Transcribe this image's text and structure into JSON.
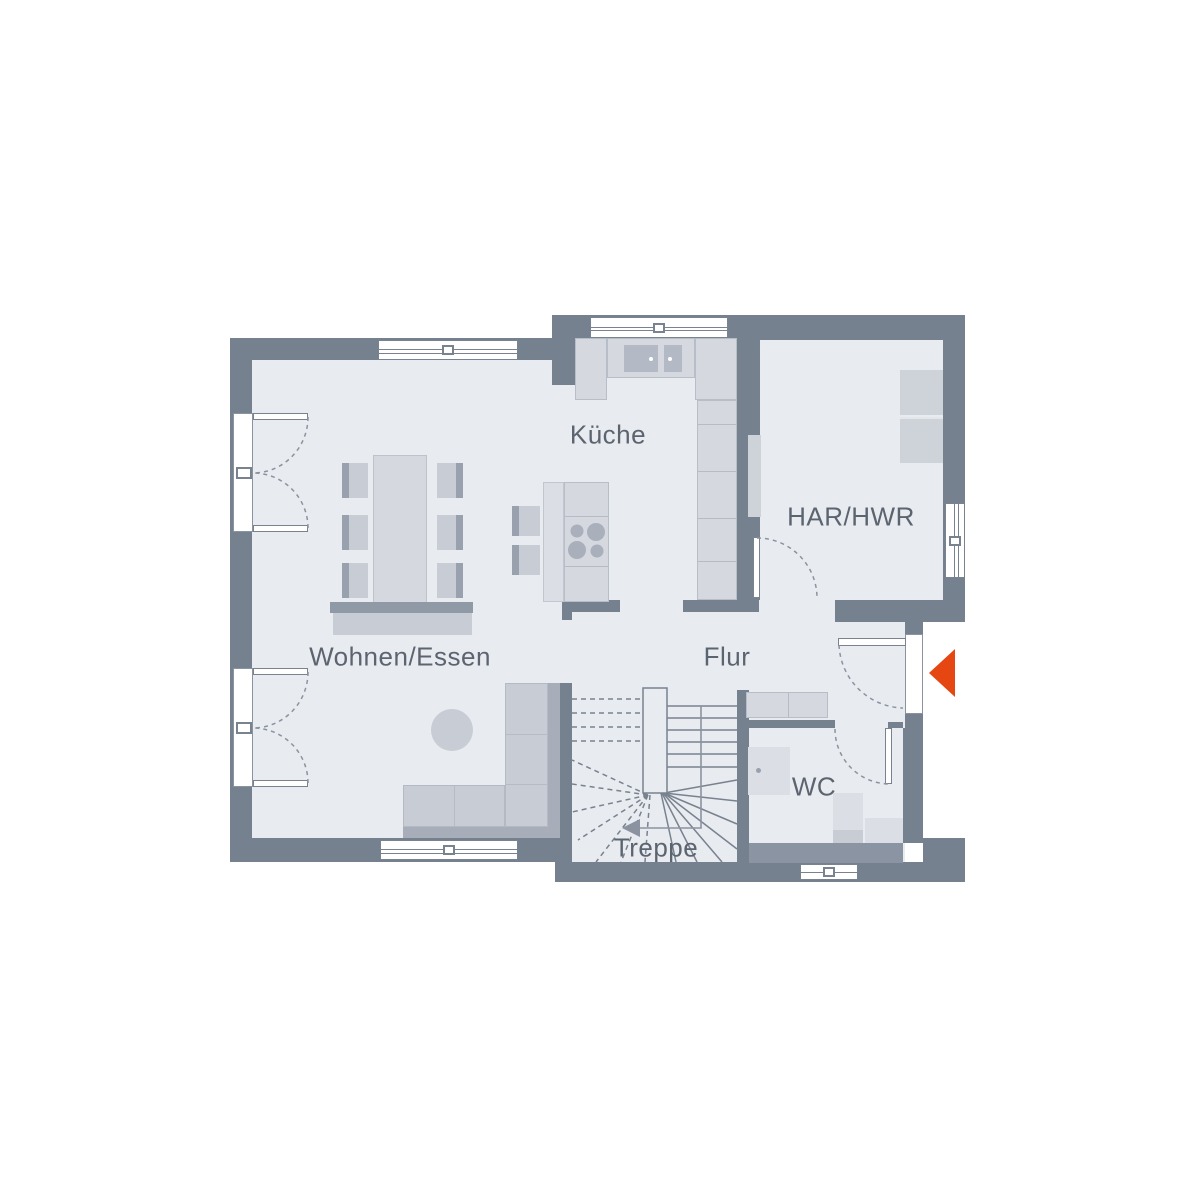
{
  "plan": {
    "type": "floor-plan",
    "rooms": [
      {
        "id": "kueche",
        "label": "Küche"
      },
      {
        "id": "har-hwr",
        "label": "HAR/HWR"
      },
      {
        "id": "wohnen-essen",
        "label": "Wohnen/Essen"
      },
      {
        "id": "flur",
        "label": "Flur"
      },
      {
        "id": "wc",
        "label": "WC"
      },
      {
        "id": "treppe",
        "label": "Treppe"
      }
    ],
    "entrance_arrow": {
      "shape": "triangle",
      "direction": "left",
      "color": "#e54612"
    },
    "colors": {
      "wall": "#76818f",
      "wall_light": "#8b94a2",
      "floor": "#e8ebf0",
      "furn_light": "#d5d8df",
      "furn_lighter": "#dbdee4",
      "furn_medium": "#c8ccd4",
      "furn_dark": "#9aa1ae",
      "sofa_back": "#a7aeba",
      "appliance": "#ced2d9",
      "basin": "#b4bac5",
      "burner": "#a9afbb",
      "line": "#79828f",
      "arc": "#8b93a0",
      "text": "#5c6470",
      "arrow": "#e54612",
      "window": "#ffffff"
    }
  }
}
